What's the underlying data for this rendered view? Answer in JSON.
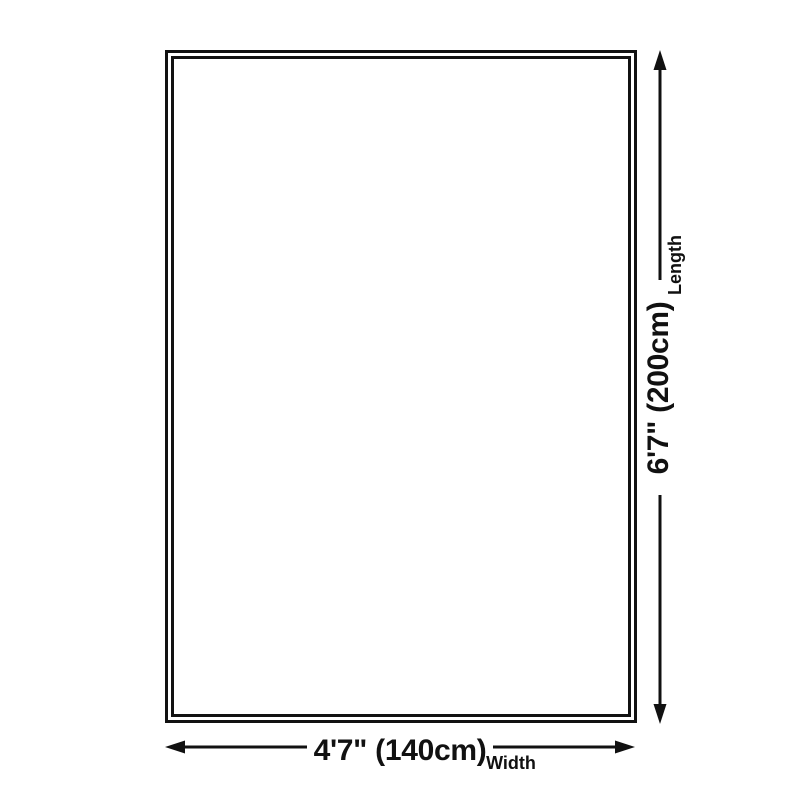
{
  "diagram": {
    "type": "product-dimension-diagram",
    "background_color": "#ffffff",
    "ink_color": "#111111",
    "length": {
      "value": "6'7\" (200cm)",
      "label": "Length"
    },
    "width": {
      "value": "4'7\" (140cm)",
      "label": "Width"
    }
  }
}
